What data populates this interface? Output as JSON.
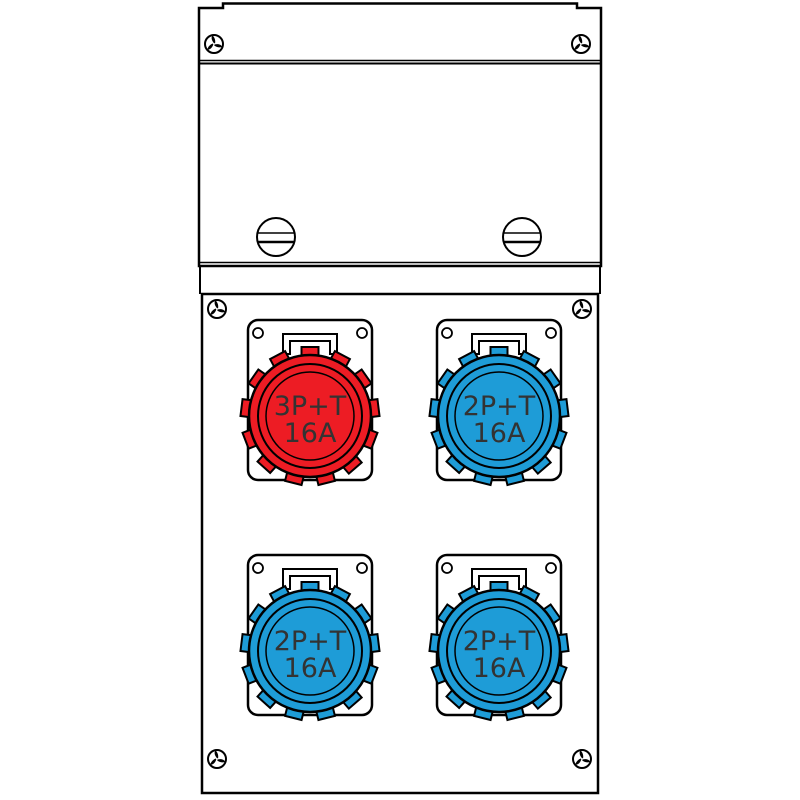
{
  "drawing": {
    "description_labels_visible_only": true,
    "background": "#ffffff",
    "line_color": "#000000"
  },
  "colors": {
    "red_socket": "#ed1c24",
    "blue_socket": "#1e9cd7",
    "label_text": "#333333",
    "background": "#ffffff",
    "line": "#000000"
  },
  "sockets": [
    {
      "position": "top-left",
      "label_line1": "3P+T",
      "label_line2": "16A",
      "color_name": "red",
      "color_hex": "#ed1c24"
    },
    {
      "position": "top-right",
      "label_line1": "2P+T",
      "label_line2": "16A",
      "color_name": "blue",
      "color_hex": "#1e9cd7"
    },
    {
      "position": "bottom-left",
      "label_line1": "2P+T",
      "label_line2": "16A",
      "color_name": "blue",
      "color_hex": "#1e9cd7"
    },
    {
      "position": "bottom-right",
      "label_line1": "2P+T",
      "label_line2": "16A",
      "color_name": "blue",
      "color_hex": "#1e9cd7"
    }
  ],
  "screws": {
    "tri_wing_count": 6,
    "slotted_count": 2
  },
  "icons": {
    "tri_wing_screw": "tri-wing-screw-icon",
    "slotted_screw": "slotted-screw-icon"
  }
}
